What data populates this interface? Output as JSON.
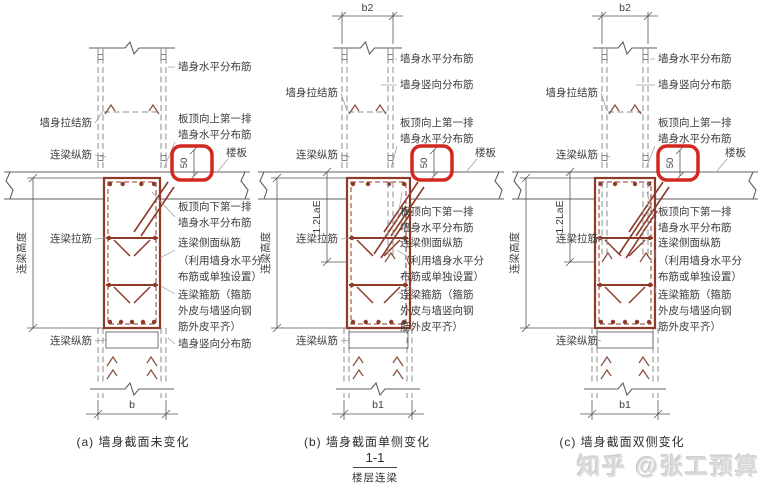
{
  "colors": {
    "rebar": "#8d3a28",
    "highlight": "#d4281e",
    "label": "#3c3c3c",
    "watermark": "#d9d9d9"
  },
  "annotations": {
    "wall_horizontal_bars": "墙身水平分布筋",
    "wall_vertical_bars": "墙身竖向分布筋",
    "wall_tie_bars": "墙身拉结筋",
    "first_row_above_slab_1": "板顶向上第一排",
    "first_row_above_slab_2": "墙身水平分布筋",
    "first_row_below_slab_1": "板顶向下第一排",
    "first_row_below_slab_2": "墙身水平分布筋",
    "floor_slab": "楼板",
    "beam_longitudinal_bars": "连梁纵筋",
    "beam_side_bars_1": "连梁侧面纵筋",
    "beam_side_bars_2": "（利用墙身水平分",
    "beam_side_bars_3": "布筋或单独设置）",
    "beam_tie_bars": "连梁拉筋",
    "beam_stirrups_1": "连梁箍筋（箍筋",
    "beam_stirrups_2": "外皮与墙竖向钢",
    "beam_stirrups_3": "筋外皮平齐）",
    "beam_height": "连梁高度",
    "offset_value": "50",
    "anchorage_length": "1.2LaE"
  },
  "panels": [
    {
      "id": "a",
      "caption": "(a) 墙身截面未变化",
      "bottom_width": "b",
      "top_width": ""
    },
    {
      "id": "b",
      "caption": "(b) 墙身截面单侧变化",
      "bottom_width": "b1",
      "top_width": "b2"
    },
    {
      "id": "c",
      "caption": "(c) 墙身截面双侧变化",
      "bottom_width": "b1",
      "top_width": "b2"
    }
  ],
  "section_mark": {
    "number": "1-1",
    "label": "楼层连梁"
  },
  "watermark": {
    "text": "知乎 @张工预算"
  }
}
